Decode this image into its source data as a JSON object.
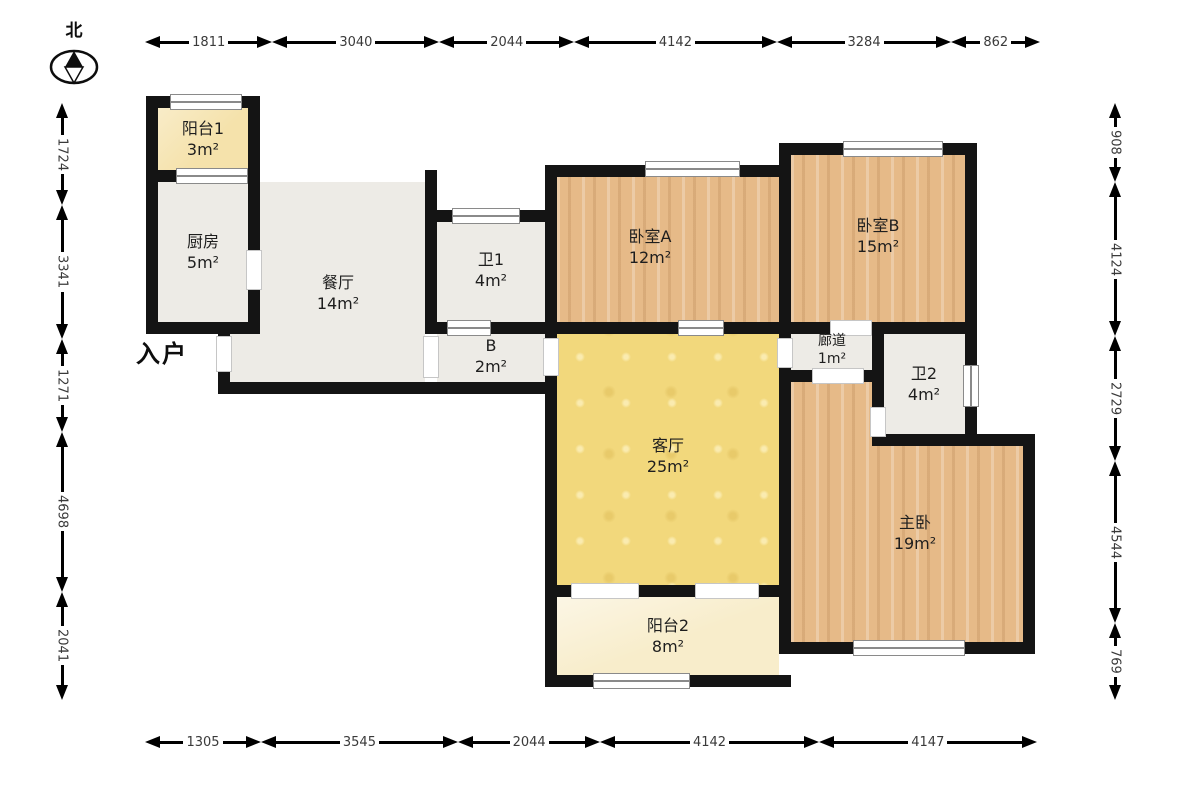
{
  "compass": {
    "label": "北"
  },
  "entry": {
    "text": "入户",
    "x": 136,
    "y": 334
  },
  "colors": {
    "wall": "#141414",
    "gray": "#edebe6",
    "wood": "#e6ba88",
    "yellow": "#f2d87c",
    "cream1": "#f5e2ab",
    "cream2": "#f8edcb",
    "dim_text": "#3a3a3a",
    "label_text": "#1e1e1e"
  },
  "rooms": [
    {
      "key": "balcony1",
      "name": "阳台1",
      "area": "3m²",
      "fill": "cream1",
      "rects": [
        [
          158,
          108,
          90,
          62
        ]
      ],
      "lx": 203,
      "ly": 139,
      "small": false
    },
    {
      "key": "kitchen",
      "name": "厨房",
      "area": "5m²",
      "fill": "gray",
      "rects": [
        [
          158,
          182,
          90,
          140
        ]
      ],
      "lx": 203,
      "ly": 252,
      "small": false
    },
    {
      "key": "dining",
      "name": "餐厅",
      "area": "14m²",
      "fill": "gray",
      "rects": [
        [
          260,
          182,
          165,
          200
        ],
        [
          230,
          334,
          30,
          48
        ]
      ],
      "lx": 338,
      "ly": 293,
      "small": false
    },
    {
      "key": "bath1",
      "name": "卫1",
      "area": "4m²",
      "fill": "gray",
      "rects": [
        [
          437,
          222,
          108,
          100
        ]
      ],
      "lx": 491,
      "ly": 270,
      "small": false
    },
    {
      "key": "passage-b",
      "name": "B",
      "area": "2m²",
      "fill": "gray",
      "rects": [
        [
          437,
          334,
          108,
          48
        ]
      ],
      "lx": 491,
      "ly": 356,
      "small": false
    },
    {
      "key": "bedroom-a",
      "name": "卧室A",
      "area": "12m²",
      "fill": "wood",
      "rects": [
        [
          557,
          177,
          222,
          145
        ]
      ],
      "lx": 650,
      "ly": 247,
      "small": false
    },
    {
      "key": "bedroom-b",
      "name": "卧室B",
      "area": "15m²",
      "fill": "wood",
      "rects": [
        [
          791,
          155,
          174,
          167
        ]
      ],
      "lx": 878,
      "ly": 236,
      "small": false
    },
    {
      "key": "corridor",
      "name": "廊道",
      "area": "1m²",
      "fill": "gray",
      "rects": [
        [
          791,
          334,
          81,
          36
        ]
      ],
      "lx": 832,
      "ly": 350,
      "small": true
    },
    {
      "key": "bath2",
      "name": "卫2",
      "area": "4m²",
      "fill": "gray",
      "rects": [
        [
          884,
          334,
          81,
          100
        ]
      ],
      "lx": 924,
      "ly": 384,
      "small": false
    },
    {
      "key": "living",
      "name": "客厅",
      "area": "25m²",
      "fill": "yellow",
      "rects": [
        [
          557,
          334,
          222,
          251
        ]
      ],
      "lx": 668,
      "ly": 456,
      "small": false
    },
    {
      "key": "master",
      "name": "主卧",
      "area": "19m²",
      "fill": "wood",
      "rects": [
        [
          791,
          382,
          81,
          260
        ],
        [
          791,
          446,
          232,
          196
        ]
      ],
      "lx": 915,
      "ly": 533,
      "small": false
    },
    {
      "key": "balcony2",
      "name": "阳台2",
      "area": "8m²",
      "fill": "cream2",
      "rects": [
        [
          557,
          597,
          222,
          78
        ]
      ],
      "lx": 668,
      "ly": 636,
      "small": false
    }
  ],
  "walls": [
    [
      146,
      96,
      112,
      12
    ],
    [
      146,
      96,
      12,
      238
    ],
    [
      146,
      170,
      112,
      12
    ],
    [
      248,
      96,
      12,
      238
    ],
    [
      146,
      322,
      114,
      12
    ],
    [
      218,
      322,
      12,
      72
    ],
    [
      218,
      382,
      339,
      12
    ],
    [
      425,
      170,
      12,
      164
    ],
    [
      425,
      210,
      125,
      12
    ],
    [
      425,
      322,
      132,
      12
    ],
    [
      545,
      165,
      12,
      522
    ],
    [
      545,
      165,
      246,
      12
    ],
    [
      545,
      322,
      246,
      12
    ],
    [
      779,
      143,
      12,
      191
    ],
    [
      779,
      143,
      198,
      12
    ],
    [
      965,
      143,
      12,
      303
    ],
    [
      779,
      322,
      198,
      12
    ],
    [
      872,
      334,
      12,
      112
    ],
    [
      779,
      370,
      104,
      12
    ],
    [
      872,
      434,
      163,
      12
    ],
    [
      779,
      322,
      12,
      332
    ],
    [
      1023,
      434,
      12,
      220
    ],
    [
      779,
      642,
      256,
      12
    ],
    [
      545,
      585,
      246,
      12
    ],
    [
      545,
      675,
      246,
      12
    ]
  ],
  "doors": [
    [
      246,
      250,
      16,
      40
    ],
    [
      216,
      336,
      16,
      36
    ],
    [
      423,
      336,
      16,
      42
    ],
    [
      543,
      338,
      16,
      38
    ],
    [
      830,
      320,
      42,
      16
    ],
    [
      812,
      368,
      52,
      16
    ],
    [
      777,
      338,
      16,
      30
    ],
    [
      870,
      407,
      16,
      30
    ],
    [
      571,
      583,
      68,
      16
    ],
    [
      695,
      583,
      64,
      16
    ]
  ],
  "windows": [
    {
      "o": "h",
      "r": [
        170,
        94,
        72,
        16
      ]
    },
    {
      "o": "h",
      "r": [
        176,
        168,
        72,
        16
      ]
    },
    {
      "o": "h",
      "r": [
        452,
        208,
        68,
        16
      ]
    },
    {
      "o": "h",
      "r": [
        645,
        161,
        95,
        16
      ]
    },
    {
      "o": "h",
      "r": [
        843,
        141,
        100,
        16
      ]
    },
    {
      "o": "h",
      "r": [
        678,
        320,
        46,
        16
      ]
    },
    {
      "o": "h",
      "r": [
        447,
        320,
        44,
        16
      ]
    },
    {
      "o": "v",
      "r": [
        963,
        365,
        16,
        42
      ]
    },
    {
      "o": "h",
      "r": [
        853,
        640,
        112,
        16
      ]
    },
    {
      "o": "h",
      "r": [
        593,
        673,
        97,
        16
      ]
    }
  ],
  "dimensions": {
    "top": {
      "orient": "h",
      "x": 145,
      "y": 32,
      "len": 895,
      "values": [
        "1811",
        "3040",
        "2044",
        "4142",
        "3284",
        "862"
      ]
    },
    "bottom": {
      "orient": "h",
      "x": 145,
      "y": 732,
      "len": 892,
      "values": [
        "1305",
        "3545",
        "2044",
        "4142",
        "4147"
      ]
    },
    "left": {
      "orient": "v",
      "x": 52,
      "y": 103,
      "len": 597,
      "values": [
        "1724",
        "3341",
        "1271",
        "4698",
        "2041"
      ]
    },
    "right": {
      "orient": "v",
      "x": 1105,
      "y": 103,
      "len": 597,
      "values": [
        "908",
        "4124",
        "2729",
        "4544",
        "769"
      ]
    }
  }
}
